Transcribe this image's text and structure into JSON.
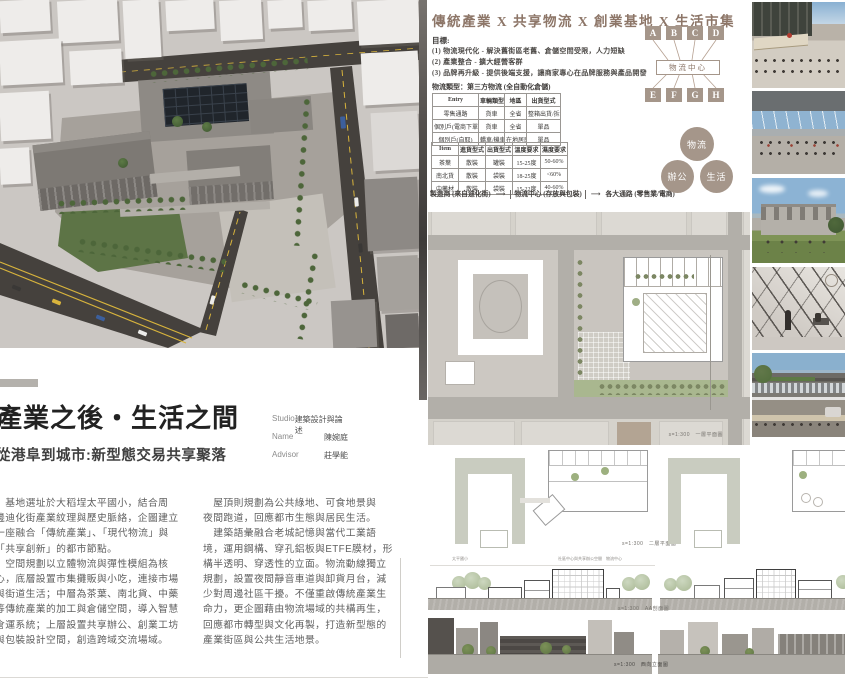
{
  "colors": {
    "accent_taupe": "#a5968a",
    "title_brown": "#8d7668",
    "road_dark": "#45413d",
    "lane_yellow": "#d7b33c",
    "tree_green": "#4d663a",
    "sky_blue": "#8fb4d3"
  },
  "info_panel": {
    "title": "傳統產業 X 共享物流 X 創業基地 X 生活市集",
    "goals_heading": "目標:",
    "goals": [
      "(1) 物流現代化 - 解決舊街區老舊、倉儲空間受限，人力短缺",
      "(2) 產業整合 - 擴大經營客群",
      "(3) 品牌再升級 - 提供後端支援，讓商家專心在品牌服務與產品開發"
    ],
    "logistics_type": "物流類型：第三方物流 (全自動化倉儲)",
    "table1": {
      "headers": [
        "Entry",
        "車輛類型",
        "地區",
        "出貨型式"
      ],
      "rows": [
        [
          "零售通路",
          "貨車",
          "全省",
          "整箱出貨/拆箱出貨"
        ],
        [
          "個別戶(電商下單)",
          "貨車",
          "全省",
          "單品"
        ],
        [
          "個別戶(自取)",
          "轎車/機車",
          "在地居民",
          "單品"
        ]
      ]
    },
    "table2": {
      "headers": [
        "Item",
        "進貨型式",
        "出貨型式",
        "溫度要求",
        "濕度要求"
      ],
      "rows": [
        [
          "茶葉",
          "散裝",
          "罐裝",
          "15-25度",
          "50-60%"
        ],
        [
          "南北貨",
          "散裝",
          "袋裝",
          "18-25度",
          "<60%"
        ],
        [
          "中藥材",
          "散裝",
          "袋裝",
          "15-22度",
          "40-60%"
        ]
      ]
    },
    "flow": {
      "from": "製造商 (來自迪化街)",
      "arrow": "⟶",
      "hub": "物流中心 (存放與包裝)",
      "to": "各大通路 (零售業/電商)"
    },
    "network": {
      "top_nodes": [
        "A",
        "B",
        "C",
        "D"
      ],
      "hub": "物流中心",
      "bottom_nodes": [
        "E",
        "F",
        "G",
        "H"
      ]
    },
    "program_circles": [
      "物流",
      "辦公",
      "生活"
    ]
  },
  "title_block": {
    "title": "產業之後・生活之間",
    "subtitle": "從港阜到城市:新型態交易共享聚落",
    "credits": [
      {
        "label": "Studio",
        "value": "建築設計與論述"
      },
      {
        "label": "Name",
        "value": "陳婉庭"
      },
      {
        "label": "Advisor",
        "value": "莊學能"
      }
    ]
  },
  "body_text": {
    "left_lines": [
      "　基地選址於大稻埕太平國小，結合周",
      "邊迪化街產業紋理與歷史脈絡，企圖建立",
      "一座融合「傳統產業」、「現代物流」與",
      "「共享創新」的都市節點。",
      "　空間規劃以立體物流與彈性模組為核",
      "心，底層設置市集攤販與小吃，連接市場",
      "與街道生活；中層為茶葉、南北貨、中藥",
      "等傳統產業的加工與倉儲空間，導入智慧",
      "倉運系統；上層設置共享辦公、創業工坊",
      "與包裝設計空間，創造跨域交流場域。"
    ],
    "right_lines": [
      "　屋頂則規劃為公共綠地、可食地景與",
      "夜間跑道，回應都市生態與居民生活。",
      "　建築語彙融合老城記憶與當代工業語",
      "境，運用鋼構、穿孔鋁板與ETFE膜材，形",
      "構半透明、穿透性的立面。物流動線獨立",
      "規劃，設置夜間靜音車道與卸貨月台，減",
      "少對周邊社區干擾。不僅重啟傳統產業生",
      "命力，更企圖藉由物流場域的共構再生，",
      "回應都市轉型與文化再製，打造新型態的",
      "產業街區與公共生活地景。"
    ]
  },
  "drawings": {
    "plan1_label": "s=1:300　一層平面圖",
    "plan2_label": "s=1:300　二層平面圖",
    "section_label": "s=1:300　AA剖面圖",
    "elevation_label": "s=1:300　西向立面圖",
    "section_annotations": [
      "太平國小",
      "社區中心與共享辦公空間",
      "物流中心"
    ]
  }
}
